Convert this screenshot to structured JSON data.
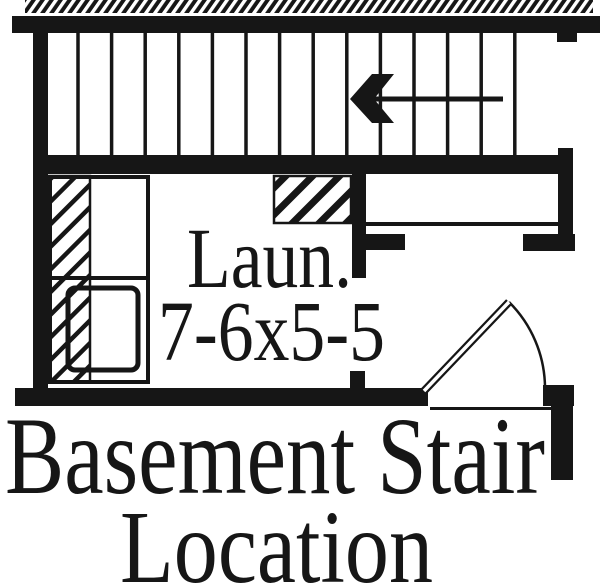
{
  "diagram": {
    "caption": {
      "line1": "Basement Stair",
      "line2": "Location"
    },
    "room": {
      "label": "Laun.",
      "dimensions": "7-6x5-5"
    },
    "stairs": {
      "tread_count": 14,
      "direction_arrow": "left"
    },
    "colors": {
      "ink": "#161616",
      "paper": "#ffffff"
    }
  }
}
